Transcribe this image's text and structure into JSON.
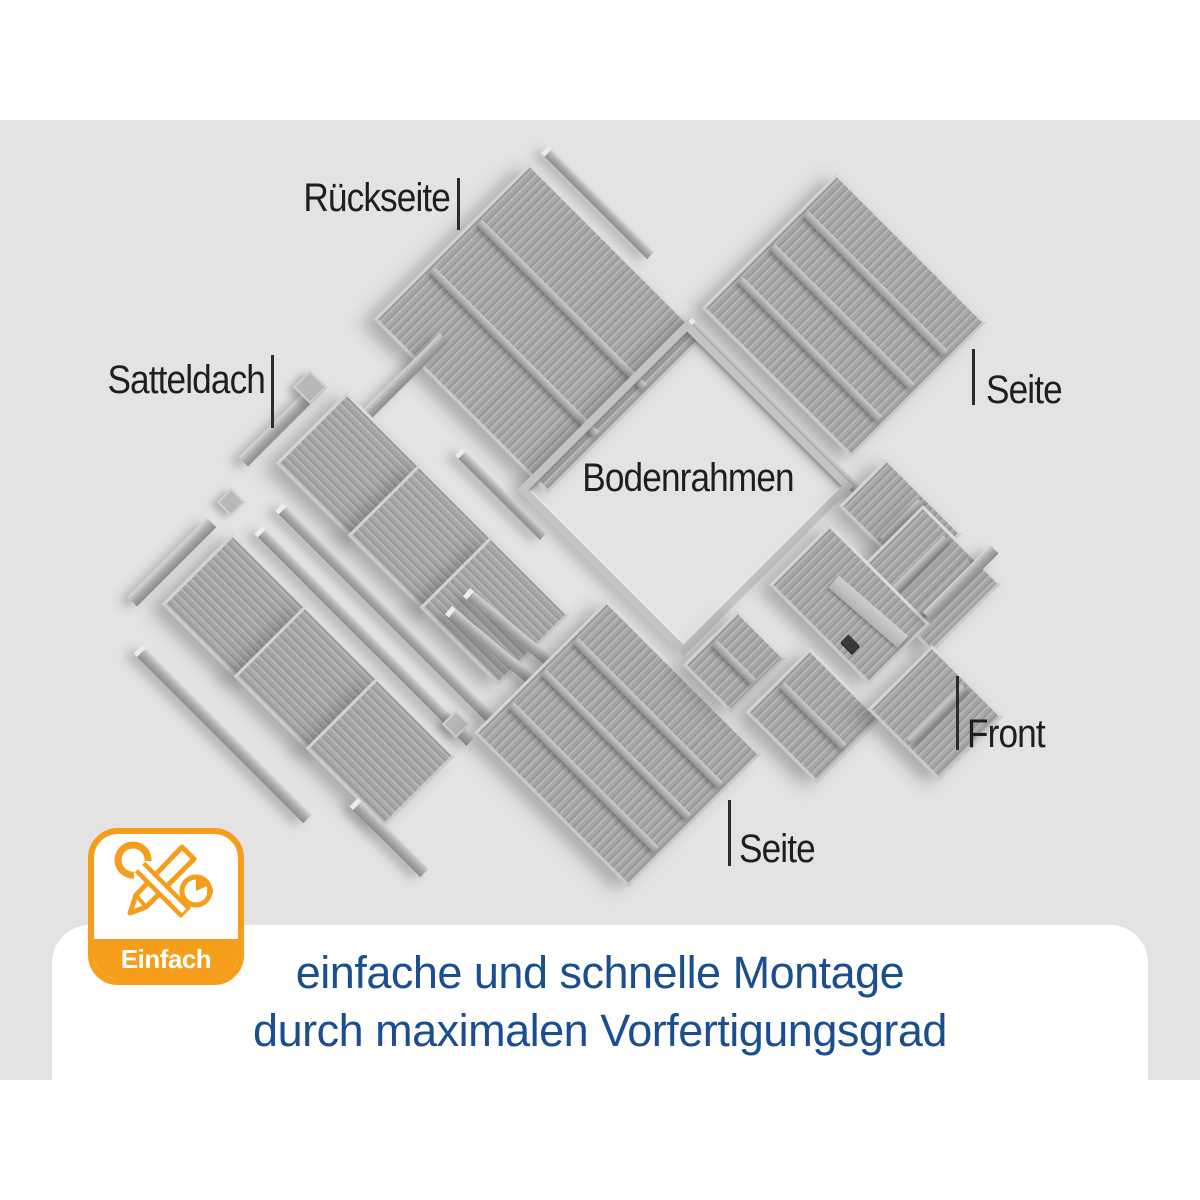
{
  "scene": {
    "labels": {
      "back": "Rückseite",
      "roof": "Satteldach",
      "floor_frame": "Bodenrahmen",
      "side_right": "Seite",
      "front": "Front",
      "side_bottom": "Seite"
    }
  },
  "badge": {
    "label": "Einfach",
    "icons": [
      "wrench-icon",
      "pencil-icon",
      "clock-pie-icon"
    ],
    "accent_color": "#F49E1B"
  },
  "caption": {
    "line1": "einfache und schnelle Montage",
    "line2": "durch maximalen Vorfertigungsgrad",
    "text_color": "#1A4E8E"
  },
  "colors": {
    "scene_background": "#E3E3E3",
    "page_background": "#FFFFFF",
    "panel_gray": "#A8A8A8",
    "label_text": "#1E1E1E"
  }
}
